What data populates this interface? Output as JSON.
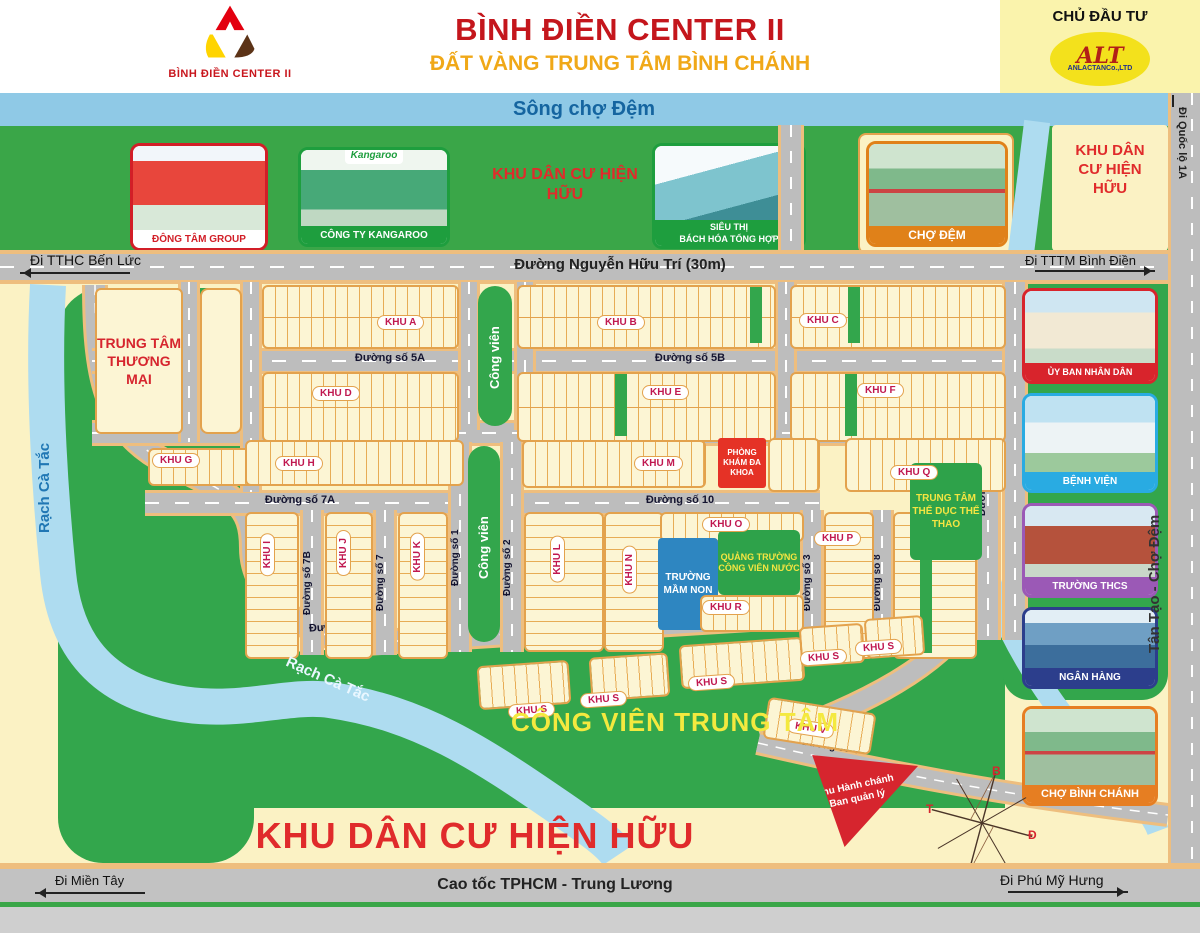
{
  "header": {
    "logo_caption": "BÌNH ĐIỀN CENTER II",
    "title": "BÌNH ĐIỀN CENTER II",
    "subtitle": "ĐẤT VÀNG TRUNG TÂM BÌNH CHÁNH",
    "developer": {
      "label": "CHỦ ĐẦU TƯ",
      "logo_text": "ALT",
      "company": "ANLACTANCo.,LTD"
    }
  },
  "colors": {
    "accent_red": "#C4161C",
    "gold": "#F0A818",
    "park_green": "#33A64C",
    "river_blue": "#AEDCF0",
    "road_gray": "#BDBDBD",
    "lot_cream": "#FCF5D4",
    "lot_line": "#E3A24D"
  },
  "top": {
    "river": "Sông chợ Đệm",
    "existing_area": "KHU DÂN CƯ HIỆN HỮU",
    "landmarks": [
      {
        "caption": "ĐÔNG TÂM GROUP",
        "frame": "#D21E27"
      },
      {
        "caption": "CÔNG TY KANGAROO",
        "sign": "Kangaroo",
        "frame": "#1E9E3E"
      },
      {
        "caption_line1": "SIÊU THỊ",
        "caption_line2": "BÁCH HÓA TỔNG HỢP",
        "frame": "#1E9E3E"
      },
      {
        "caption": "CHỢ ĐỆM",
        "frame": "#E08119"
      }
    ]
  },
  "roads": {
    "main": "Đường Nguyễn Hữu Trí (30m)",
    "to_ben_luc": "Đi TTHC Bến Lức",
    "to_binh_dien": "Đi TTTM Bình Điền",
    "to_quoc_lo_1a": "Đi Quốc lộ 1A",
    "tan_tao_cho_dem": "Tân Tạo - Chợ Đệm",
    "highway": "Cao tốc TPHCM - Trung Lương",
    "to_mien_tay": "Đi Miền Tây",
    "to_phu_my_hung": "Đi Phú Mỹ Hưng"
  },
  "streets": {
    "s1": "Đường số 1",
    "s2": "Đường số 2",
    "s3": "Đường số 3",
    "s4": "Đường số 4",
    "s5a": "Đường số 5A",
    "s5b": "Đường số 5B",
    "s6": "Đường số 6",
    "s7": "Đường số 7",
    "s7a": "Đường số 7A",
    "s7b": "Đường số 7B",
    "s8": "Đường số 8",
    "s9": "Đường số 9",
    "s10": "Đường số 10"
  },
  "zones": {
    "a": "KHU A",
    "b": "KHU B",
    "c": "KHU C",
    "d": "KHU D",
    "e": "KHU E",
    "f": "KHU F",
    "g": "KHU G",
    "h": "KHU H",
    "i": "KHU I",
    "j": "KHU J",
    "k": "KHU K",
    "l": "KHU L",
    "m": "KHU M",
    "n": "KHU N",
    "o": "KHU O",
    "p": "KHU P",
    "q": "KHU Q",
    "r": "KHU R",
    "s": "KHU S",
    "v": "KHU V"
  },
  "facilities": {
    "trade_center": "TRUNG TÂM THƯƠNG MẠI",
    "clinic": "PHÒNG KHÁM ĐA KHOA",
    "kindergarten": "TRƯỜNG MẦM NON",
    "water_square": "QUẢNG TRƯỜNG CÔNG VIÊN NƯỚC",
    "sports_center": "TRUNG TÂM THỂ DỤC THỂ THAO",
    "central_park": "CÔNG VIÊN TRUNG TÂM",
    "admin_area": "Khu Hành chánh Ban quản lý",
    "park_strip": "Công viên"
  },
  "sidebar": {
    "cards": [
      {
        "caption": "ỦY BAN NHÂN DÂN",
        "frame": "#D8242C"
      },
      {
        "caption": "BỆNH VIỆN",
        "frame": "#29ABE2"
      },
      {
        "caption": "TRƯỜNG THCS",
        "frame": "#9B59B6"
      },
      {
        "caption": "NGÂN HÀNG",
        "frame": "#2C3E8C"
      },
      {
        "caption": "CHỢ BÌNH CHÁNH",
        "frame": "#E67E22"
      }
    ]
  },
  "river": {
    "rach_ca_tac": "Rạch Cà Tắc"
  },
  "bottom": {
    "existing_area": "KHU DÂN CƯ HIỆN HỮU"
  },
  "compass": {
    "north": "B",
    "south": "N",
    "east": "Đ",
    "west": "T"
  }
}
